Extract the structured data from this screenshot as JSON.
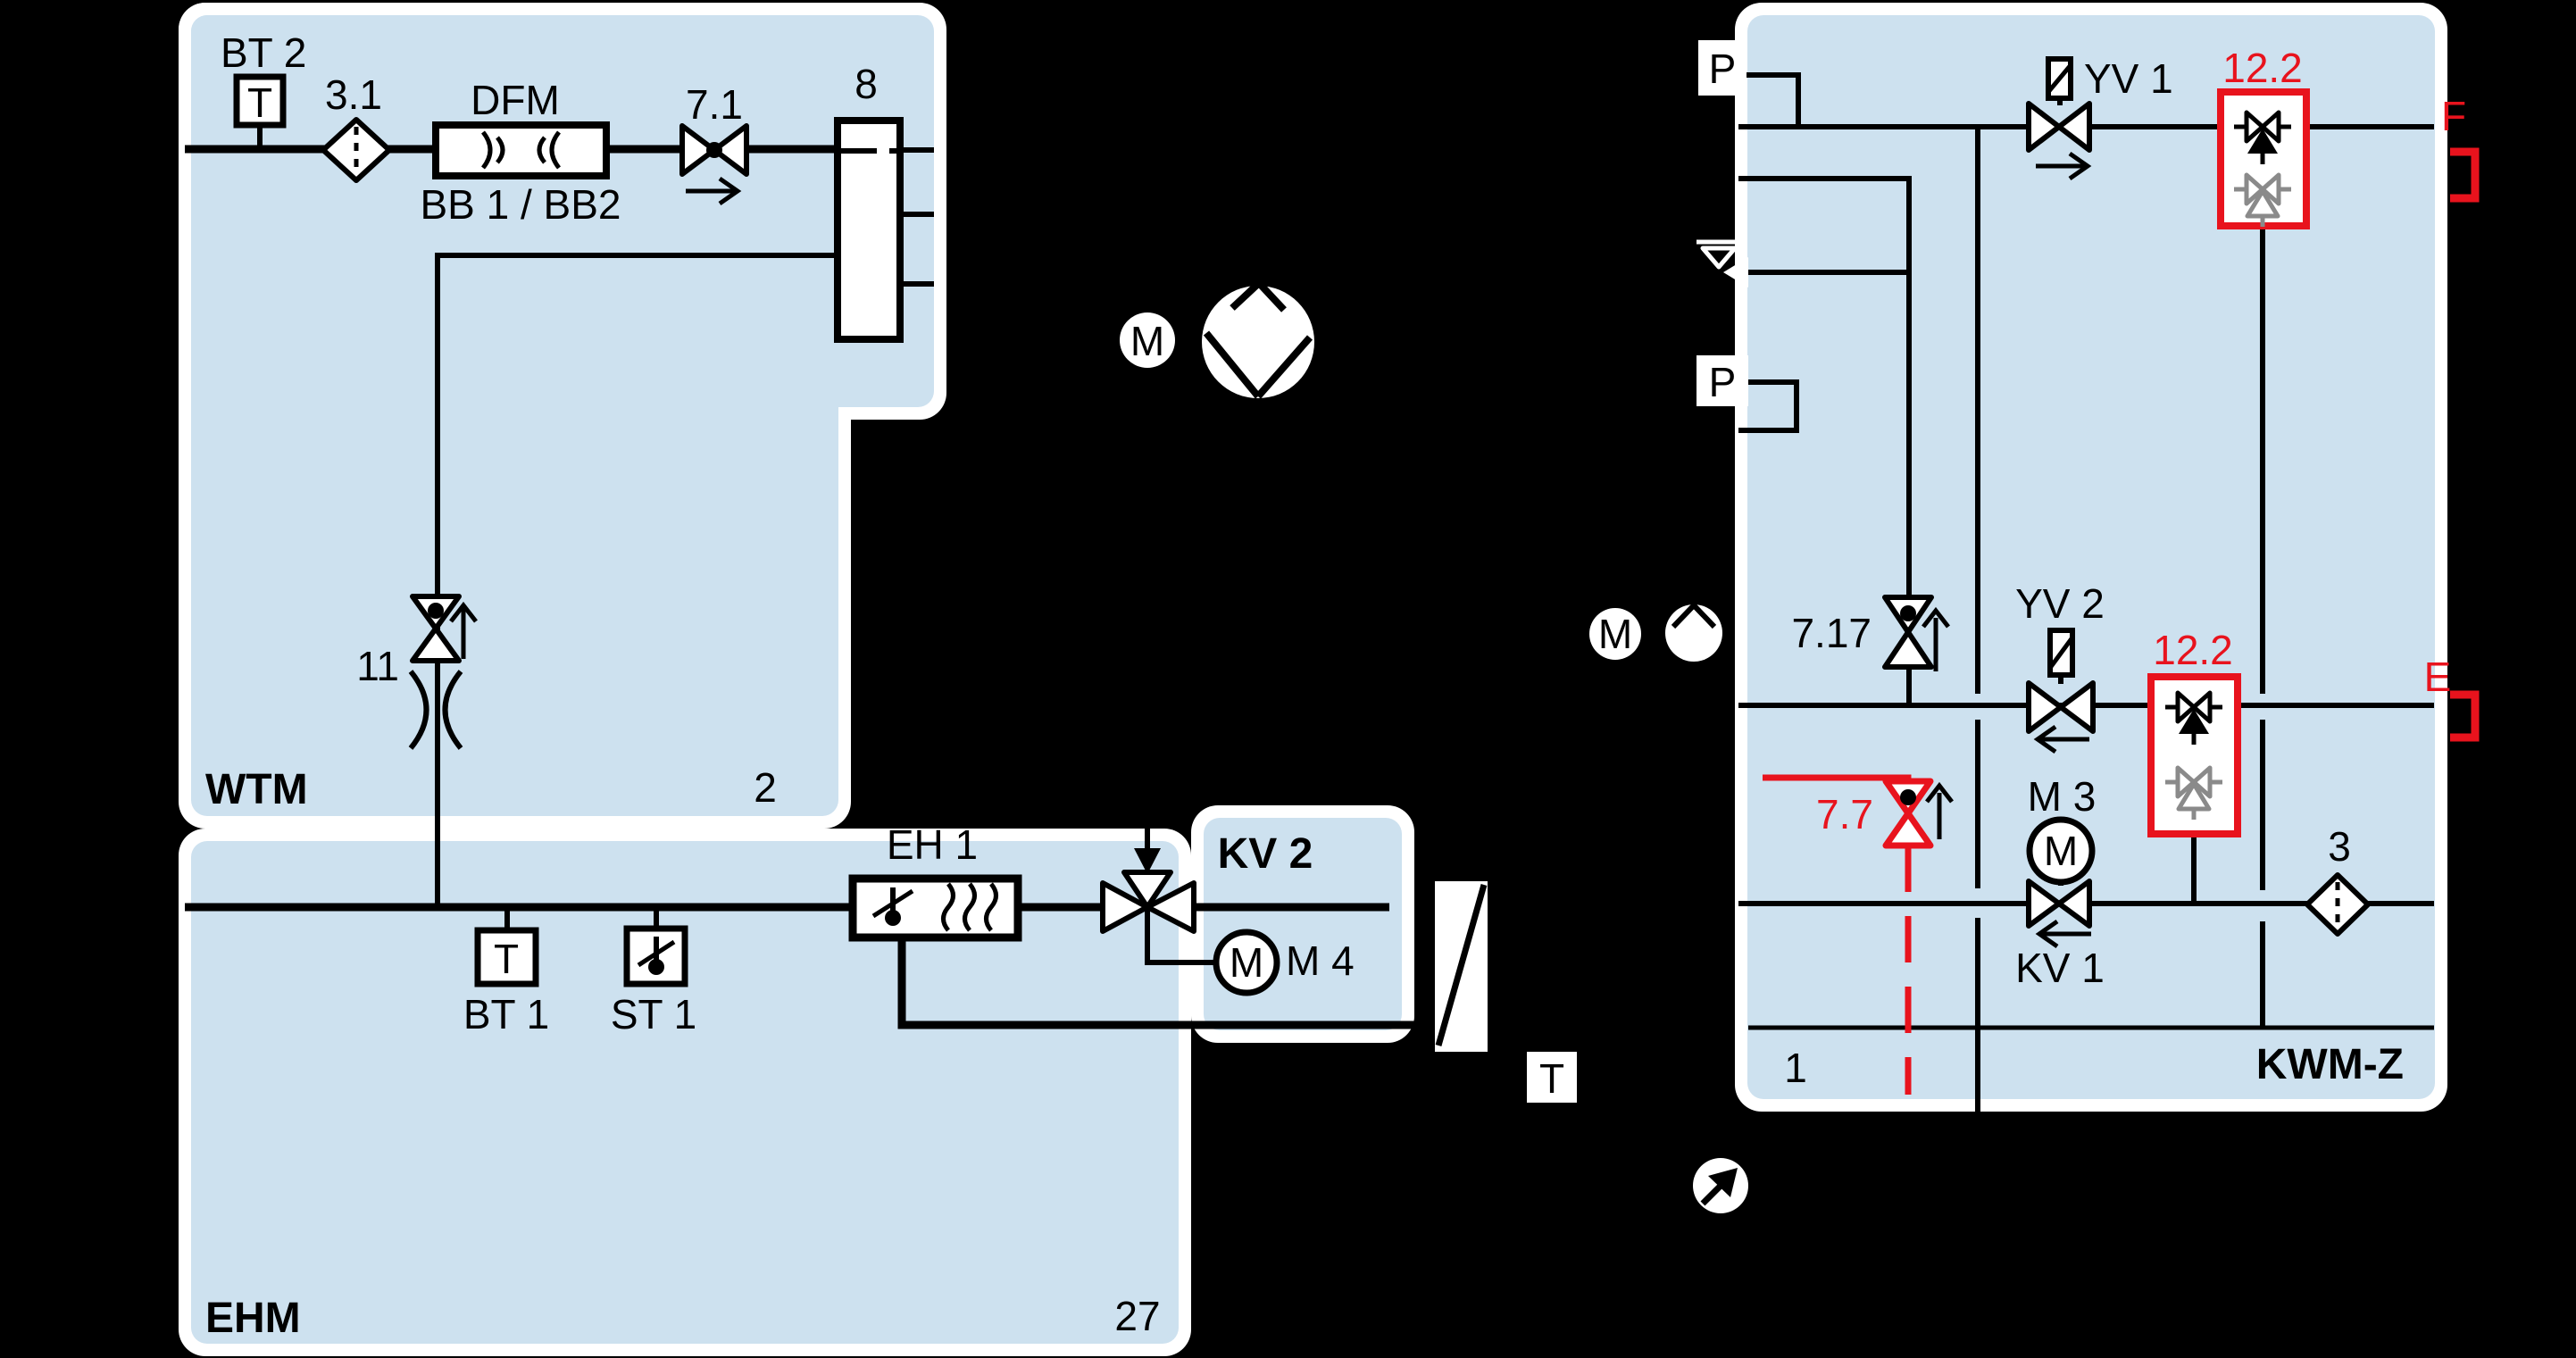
{
  "colors": {
    "background": "#000000",
    "block_fill": "#cde1ef",
    "block_border": "#ffffff",
    "line": "#000000",
    "accent_red": "#e8131d",
    "muted_gray": "#8a8a8a"
  },
  "blocks": {
    "wtm": {
      "label": "WTM",
      "corner_number": "2"
    },
    "ehm": {
      "label": "EHM",
      "corner_number": "27"
    },
    "kv2": {
      "label": "KV 2"
    },
    "kwmz": {
      "label": "KWM-Z",
      "corner_number": "1"
    }
  },
  "wtm": {
    "bt2": {
      "label": "BT 2",
      "symbol": "T"
    },
    "filter": {
      "label": "3.1"
    },
    "flowmeter": {
      "label": "DFM",
      "sublabel": "BB 1 / BB2"
    },
    "valve71": {
      "label": "7.1"
    },
    "manifold": {
      "label": "8"
    },
    "valve11": {
      "label": "11"
    }
  },
  "ehm": {
    "bt1": {
      "label": "BT 1",
      "symbol": "T"
    },
    "st1": {
      "label": "ST 1"
    },
    "heater": {
      "label": "EH 1"
    }
  },
  "kv2": {
    "motor": {
      "label": "M 4",
      "symbol": "M"
    }
  },
  "kwmz": {
    "pressure_top": {
      "symbol": "P"
    },
    "pressure_mid": {
      "symbol": "P"
    },
    "yv1": {
      "label": "YV 1"
    },
    "separator_top": {
      "label": "12.2"
    },
    "outlet_f": {
      "label": "F"
    },
    "valve717": {
      "label": "7.17"
    },
    "yv2": {
      "label": "YV 2"
    },
    "separator_mid": {
      "label": "12.2"
    },
    "outlet_e": {
      "label": "E"
    },
    "valve77": {
      "label": "7.7"
    },
    "m3": {
      "label": "M 3",
      "symbol": "M"
    },
    "kv1": {
      "label": "KV 1"
    },
    "filter3": {
      "label": "3"
    }
  },
  "outside": {
    "pump_main": {
      "symbol": "M"
    },
    "pump_kwm": {
      "symbol": "M"
    },
    "drain_t": {
      "symbol": "T"
    }
  }
}
